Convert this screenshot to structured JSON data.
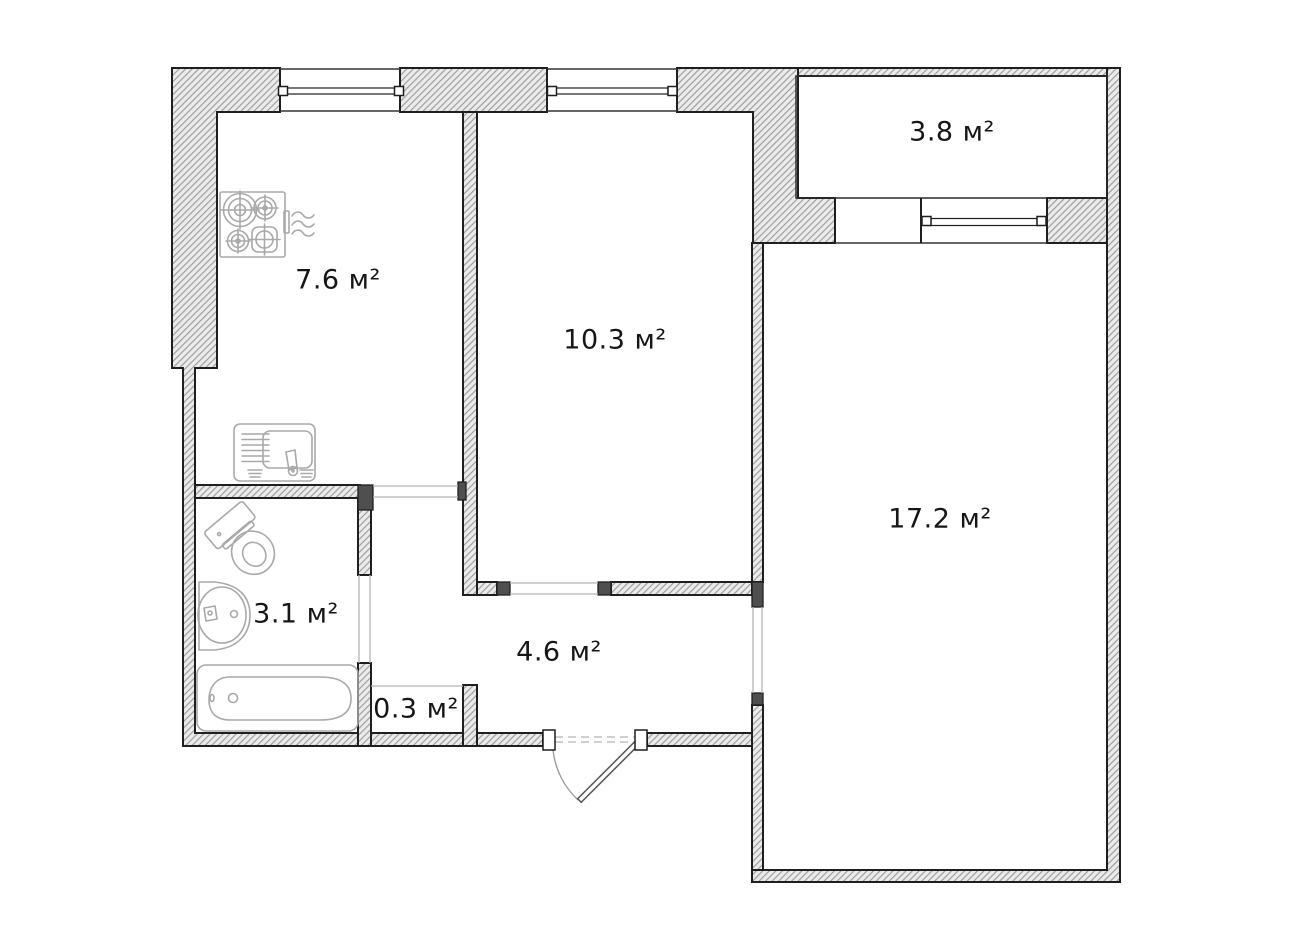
{
  "floor_plan": {
    "unit": "м²",
    "rooms": [
      {
        "id": "kitchen",
        "area_label": "7.6 м²",
        "label_x": 338,
        "label_y": 280
      },
      {
        "id": "room-medium",
        "area_label": "10.3 м²",
        "label_x": 615,
        "label_y": 340
      },
      {
        "id": "balcony",
        "area_label": "3.8 м²",
        "label_x": 952,
        "label_y": 132
      },
      {
        "id": "room-large",
        "area_label": "17.2 м²",
        "label_x": 940,
        "label_y": 519
      },
      {
        "id": "bathroom",
        "area_label": "3.1 м²",
        "label_x": 296,
        "label_y": 614
      },
      {
        "id": "hallway",
        "area_label": "4.6 м²",
        "label_x": 559,
        "label_y": 652
      },
      {
        "id": "closet",
        "area_label": "0.3 м²",
        "label_x": 416,
        "label_y": 709
      }
    ],
    "fixtures": [
      "stove",
      "kitchen-sink",
      "toilet",
      "washbasin",
      "bathtub",
      "entrance-door"
    ],
    "windows": [
      "kitchen-window",
      "room-medium-window",
      "balcony-window"
    ],
    "colors": {
      "background": "#ffffff",
      "wall_outline": "#1f1f1f",
      "wall_hatch_bg": "#ebebeb",
      "wall_hatch_line": "#9c9c9c",
      "jamb_fill": "#4f4f4f",
      "fixture_stroke": "#a9a9a9",
      "door_stroke": "#555555",
      "open_line": "#b5b5b5",
      "dash_line": "#b5b5b5",
      "label_color": "#161616"
    }
  }
}
